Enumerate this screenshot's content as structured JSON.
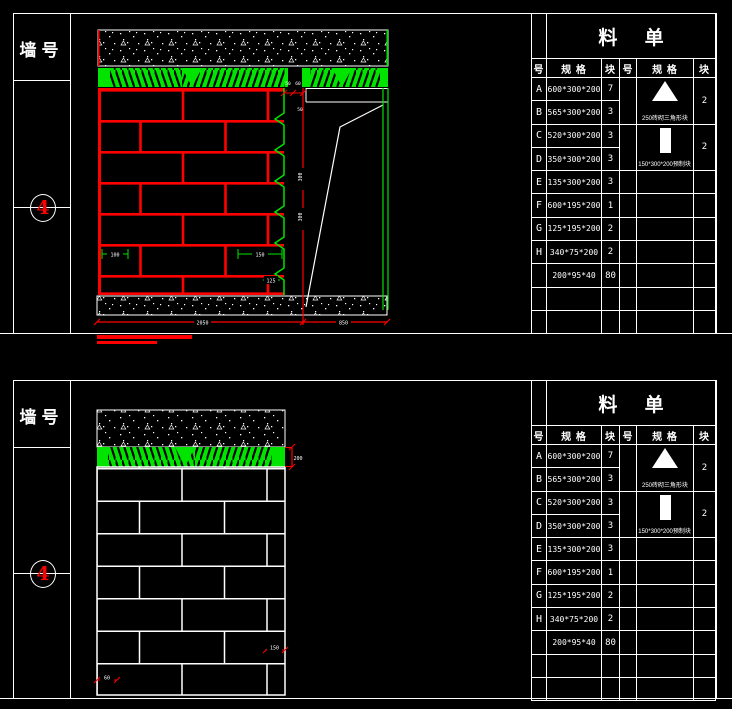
{
  "colors": {
    "cad_red": "#ff0000",
    "cad_green": "#00e400",
    "line_white": "#ffffff",
    "bg": "#000000"
  },
  "panels": [
    {
      "wall_label": "墙号",
      "wall_no": "4",
      "dims": {
        "top_1": "50",
        "top_2": "60",
        "ledge": "50",
        "side_1": "300",
        "side_2": "300",
        "brick_1": "100",
        "brick_2": "150",
        "brick_3": "125",
        "bottom_main": "2050",
        "bottom_right": "850"
      }
    },
    {
      "wall_label": "墙号",
      "wall_no": "4",
      "dims": {
        "band_right": "200",
        "right_1": "150",
        "left_1": "60",
        "bottom_main": "1865"
      }
    }
  ],
  "material_table": {
    "title": "料 单",
    "headers": [
      "号",
      "规 格",
      "块",
      "号",
      "规 格",
      "块"
    ],
    "rows": [
      {
        "no": "A",
        "spec": "600*300*200",
        "qty": "7"
      },
      {
        "no": "B",
        "spec": "565*300*200",
        "qty": "3"
      },
      {
        "no": "C",
        "spec": "520*300*200",
        "qty": "3"
      },
      {
        "no": "D",
        "spec": "350*300*200",
        "qty": "3"
      },
      {
        "no": "E",
        "spec": "135*300*200",
        "qty": "3"
      },
      {
        "no": "F",
        "spec": "600*195*200",
        "qty": "1"
      },
      {
        "no": "G",
        "spec": "125*195*200",
        "qty": "2"
      },
      {
        "no": "H",
        "spec": "340*75*200",
        "qty": "2"
      },
      {
        "no": "",
        "spec": "200*95*40",
        "qty": "80"
      }
    ],
    "special": [
      {
        "icon": "triangle-block-icon",
        "label": "250砖砌三角形块",
        "qty": "2"
      },
      {
        "icon": "rect-block-icon",
        "label": "150*300*200预制块",
        "qty": "2"
      }
    ]
  }
}
